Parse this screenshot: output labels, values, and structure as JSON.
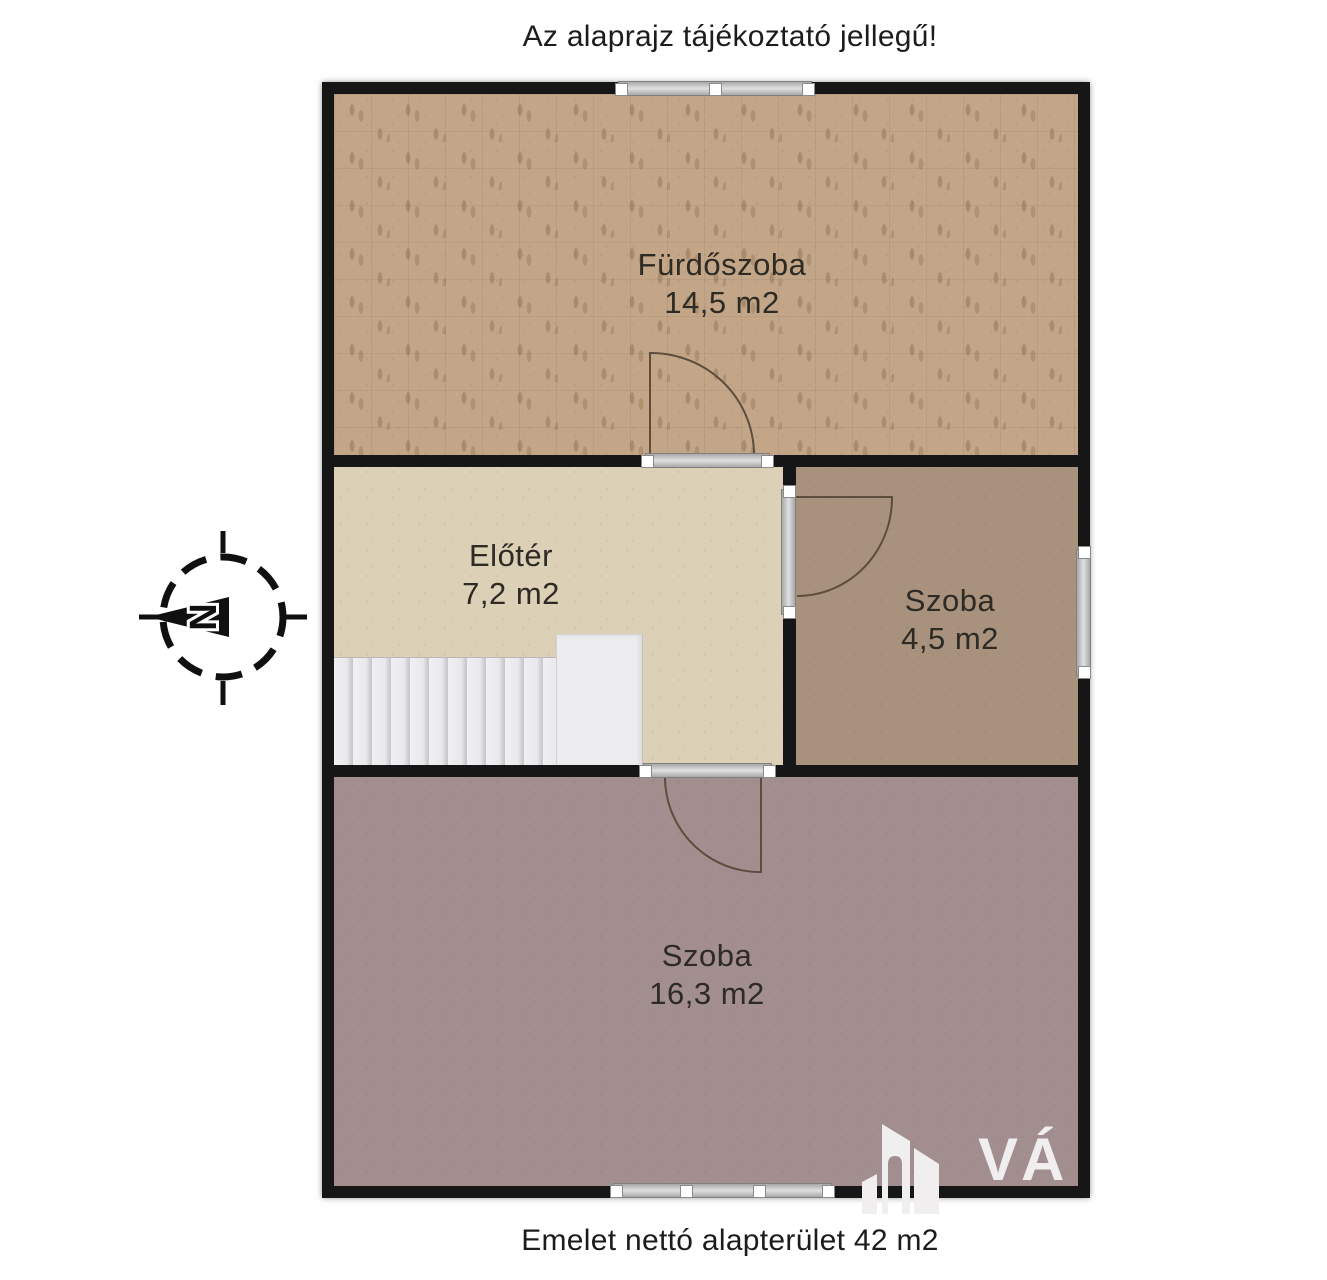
{
  "title": "Az alaprajz tájékoztató jellegű!",
  "footer": "Emelet nettó alapterület 42 m2",
  "compass": {
    "north_letter": "N"
  },
  "watermark": {
    "text": "VÁ"
  },
  "colors": {
    "wall": "#161616",
    "bathroom_floor": "#c3a687",
    "hall_floor": "#dcd0b6",
    "small_room_floor": "#a8927e",
    "large_room_floor": "#a28e8e",
    "stair_fill": "#ededef",
    "door_line": "#5d4d3d",
    "frame_gray": "#c9c9c9"
  },
  "rooms": {
    "bathroom": {
      "name": "Fürdőszoba",
      "area": "14,5 m2"
    },
    "hall": {
      "name": "Előtér",
      "area": "7,2 m2"
    },
    "small_room": {
      "name": "Szoba",
      "area": "4,5 m2"
    },
    "large_room": {
      "name": "Szoba",
      "area": "16,3 m2"
    }
  }
}
